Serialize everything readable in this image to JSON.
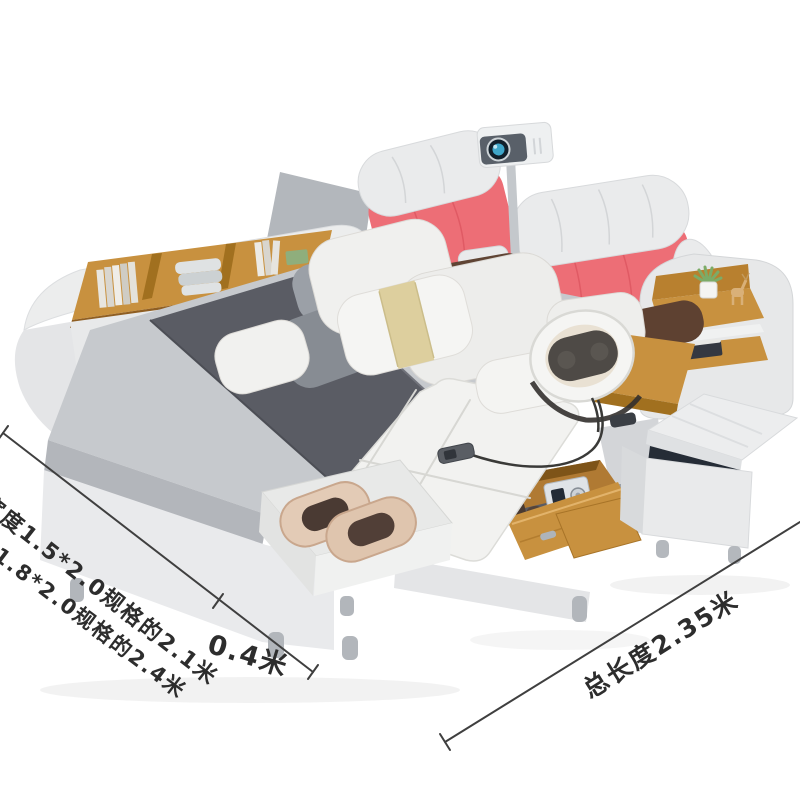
{
  "scene": {
    "description": "Product photo of a white multifunctional smart bed: pink-and-white tufted headboard with projector and speaker, side rail bookshelf, gray mattress with dark runner, pillows, massage lounger with neck massager and foot roller massager, open wooden drawer with safe, wooden nightstand shelf with plant and deer figurine, storage ottoman with open lid",
    "objects": [
      "projector",
      "headboard-cushions",
      "speaker-box",
      "bookshelf-side-rail",
      "mattress",
      "bed-runner",
      "pillows",
      "massage-lounger",
      "neck-massager",
      "foot-massager",
      "storage-drawer",
      "safe-box",
      "drawer-panel",
      "side-table",
      "nightstand-shelf",
      "storage-ottoman",
      "remote-control",
      "bed-base-legs"
    ]
  },
  "annotations": {
    "width_spec_1": "宽度1.5*2.0规格的2.1米",
    "width_spec_2": "1.8*2.0规格的2.4米",
    "side_width": "0.4米",
    "total_length": "总长度2.35米"
  },
  "colors": {
    "background": "#ffffff",
    "headboard_pink": "#ed6e76",
    "cushion_white": "#eaebec",
    "mattress_gray": "#c6c9cd",
    "runner_dark": "#5a5c64",
    "wood": "#c8913f",
    "frame_light": "#e9eaec",
    "lounger_white": "#f2f2f0",
    "accent_band": "#ddcf9e",
    "dimension_line": "#3f3f3f",
    "lens_blue": "#3fa6c9"
  }
}
